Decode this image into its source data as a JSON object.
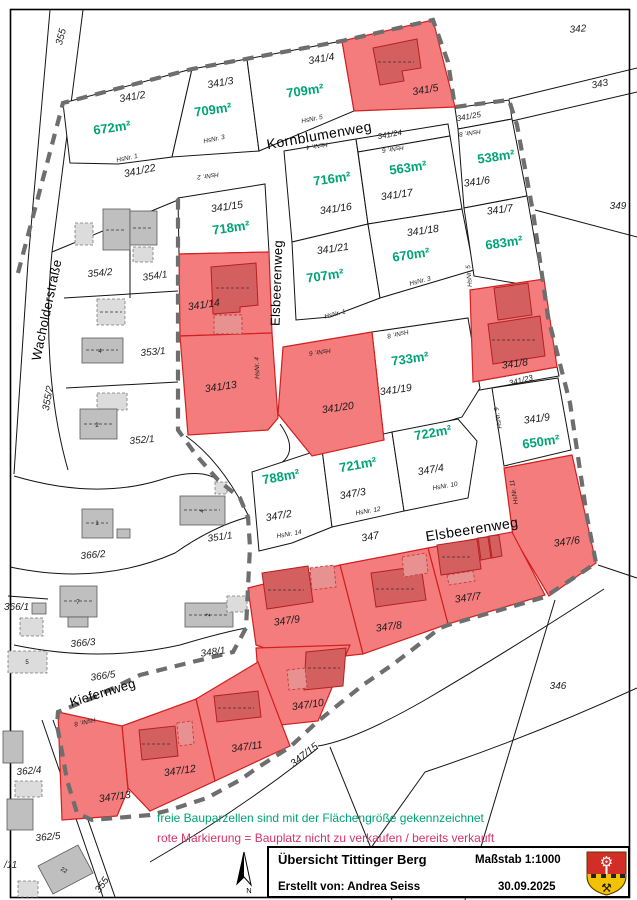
{
  "map": {
    "streets": {
      "kornblumenweg": "Kornblumenweg",
      "elsbeerenweg": "Elsbeerenweg",
      "wacholderstrasse": "Wacholderstraße",
      "kiefernweg": "Kiefernweg"
    },
    "plots": {
      "p341_2": {
        "number": "341/2",
        "area": "672m²",
        "hsnr": "HsNr. 1"
      },
      "p341_3": {
        "number": "341/3",
        "area": "709m²",
        "hsnr": "HsNr. 3"
      },
      "p341_4": {
        "number": "341/4",
        "area": "709m²",
        "hsnr": "HsNr. 5"
      },
      "p341_5": {
        "number": "341/5"
      },
      "p341_15": {
        "number": "341/15",
        "area": "718m²",
        "hsnr": "HsNr. 2"
      },
      "p341_16": {
        "number": "341/16",
        "area": "716m²",
        "hsnr": "HsNr. 4"
      },
      "p341_17": {
        "number": "341/17",
        "area": "563m²",
        "hsnr": "HsNr. 6"
      },
      "p341_6": {
        "number": "341/6",
        "area": "538m²",
        "hsnr": "HsNr. 8"
      },
      "p341_7": {
        "number": "341/7",
        "area": "683m²",
        "hsnr": "HsNr. 5"
      },
      "p341_21": {
        "number": "341/21",
        "area": "707m²",
        "hsnr": "HsNr. 1"
      },
      "p341_18": {
        "number": "341/18",
        "area": "670m²",
        "hsnr": "HsNr. 3"
      },
      "p341_14": {
        "number": "341/14"
      },
      "p341_13": {
        "number": "341/13",
        "hsnr": "HsNr. 4"
      },
      "p341_20": {
        "number": "341/20",
        "hsnr": "HsNr. 6"
      },
      "p341_19": {
        "number": "341/19",
        "area": "733m²",
        "hsnr": "HsNr. 8"
      },
      "p341_8": {
        "number": "341/8"
      },
      "p341_9": {
        "number": "341/9",
        "area": "650m²",
        "hsnr": "HsNr. 9"
      },
      "p347_2": {
        "number": "347/2",
        "area": "788m²",
        "hsnr": "HsNr. 14"
      },
      "p347_3": {
        "number": "347/3",
        "area": "721m²",
        "hsnr": "HsNr. 12"
      },
      "p347_4": {
        "number": "347/4",
        "area": "722m²",
        "hsnr": "HsNr. 10"
      },
      "p347_6": {
        "number": "347/6",
        "hsnr": "HsNr. 11"
      },
      "p347_7": {
        "number": "347/7"
      },
      "p347_8": {
        "number": "347/8"
      },
      "p347_9": {
        "number": "347/9"
      },
      "p347_10": {
        "number": "347/10"
      },
      "p347_11": {
        "number": "347/11"
      },
      "p347_12": {
        "number": "347/12"
      },
      "p347_13": {
        "number": "347/13",
        "hsnr": "HsNr. 8"
      }
    },
    "road_parcels": {
      "r341_22": "341/22",
      "r341_23": "341/23",
      "r341_24": "341/24",
      "r341_25": "341/25",
      "r347": "347",
      "r347_15": "347/15",
      "r355_top": "355",
      "r355_bottom": "355"
    },
    "surroundings": {
      "s342": "342",
      "s343": "343",
      "s349": "349",
      "s346": "346",
      "s355_2": "355/2",
      "s354_2": "354/2",
      "s354_1": "354/1",
      "s353_1": "353/1",
      "s352_1": "352/1",
      "s366_1": "366/1",
      "s366_2": "366/2",
      "s366_3": "366/3",
      "s366_5": "366/5",
      "s351_1": "351/1",
      "s348_1": "348/1",
      "s362_4": "362/4",
      "s362_5": "362/5",
      "s_11": "/11"
    },
    "house_numbers": {
      "hs366_2": "1",
      "hs366_3": "7",
      "hs366_1": "5",
      "hs353_1": "4",
      "hs352_1": "2",
      "hs351_1": "4",
      "hs348_1": "2",
      "hs362_5": "22"
    },
    "north_label": "N"
  },
  "legend": {
    "line1": "freie Bauparzellen sind mit der Flächengröße gekennzeichnet",
    "line2": "rote Markierung = Bauplatz nicht zu verkaufen / bereits verkauft"
  },
  "titleblock": {
    "title": "Übersicht Tittinger Berg",
    "scale": "Maßstab 1:1000",
    "author": "Erstellt von: Andrea Seiss",
    "date": "30.09.2025",
    "crest": "tittling-coat-of-arms"
  },
  "colors": {
    "available_label": "#00a377",
    "sold_fill": "#f57c7c",
    "sold_outline": "#d21f1f",
    "legend_sold_text": "#d6336c",
    "boundary_dash": "#6e6e6e"
  }
}
